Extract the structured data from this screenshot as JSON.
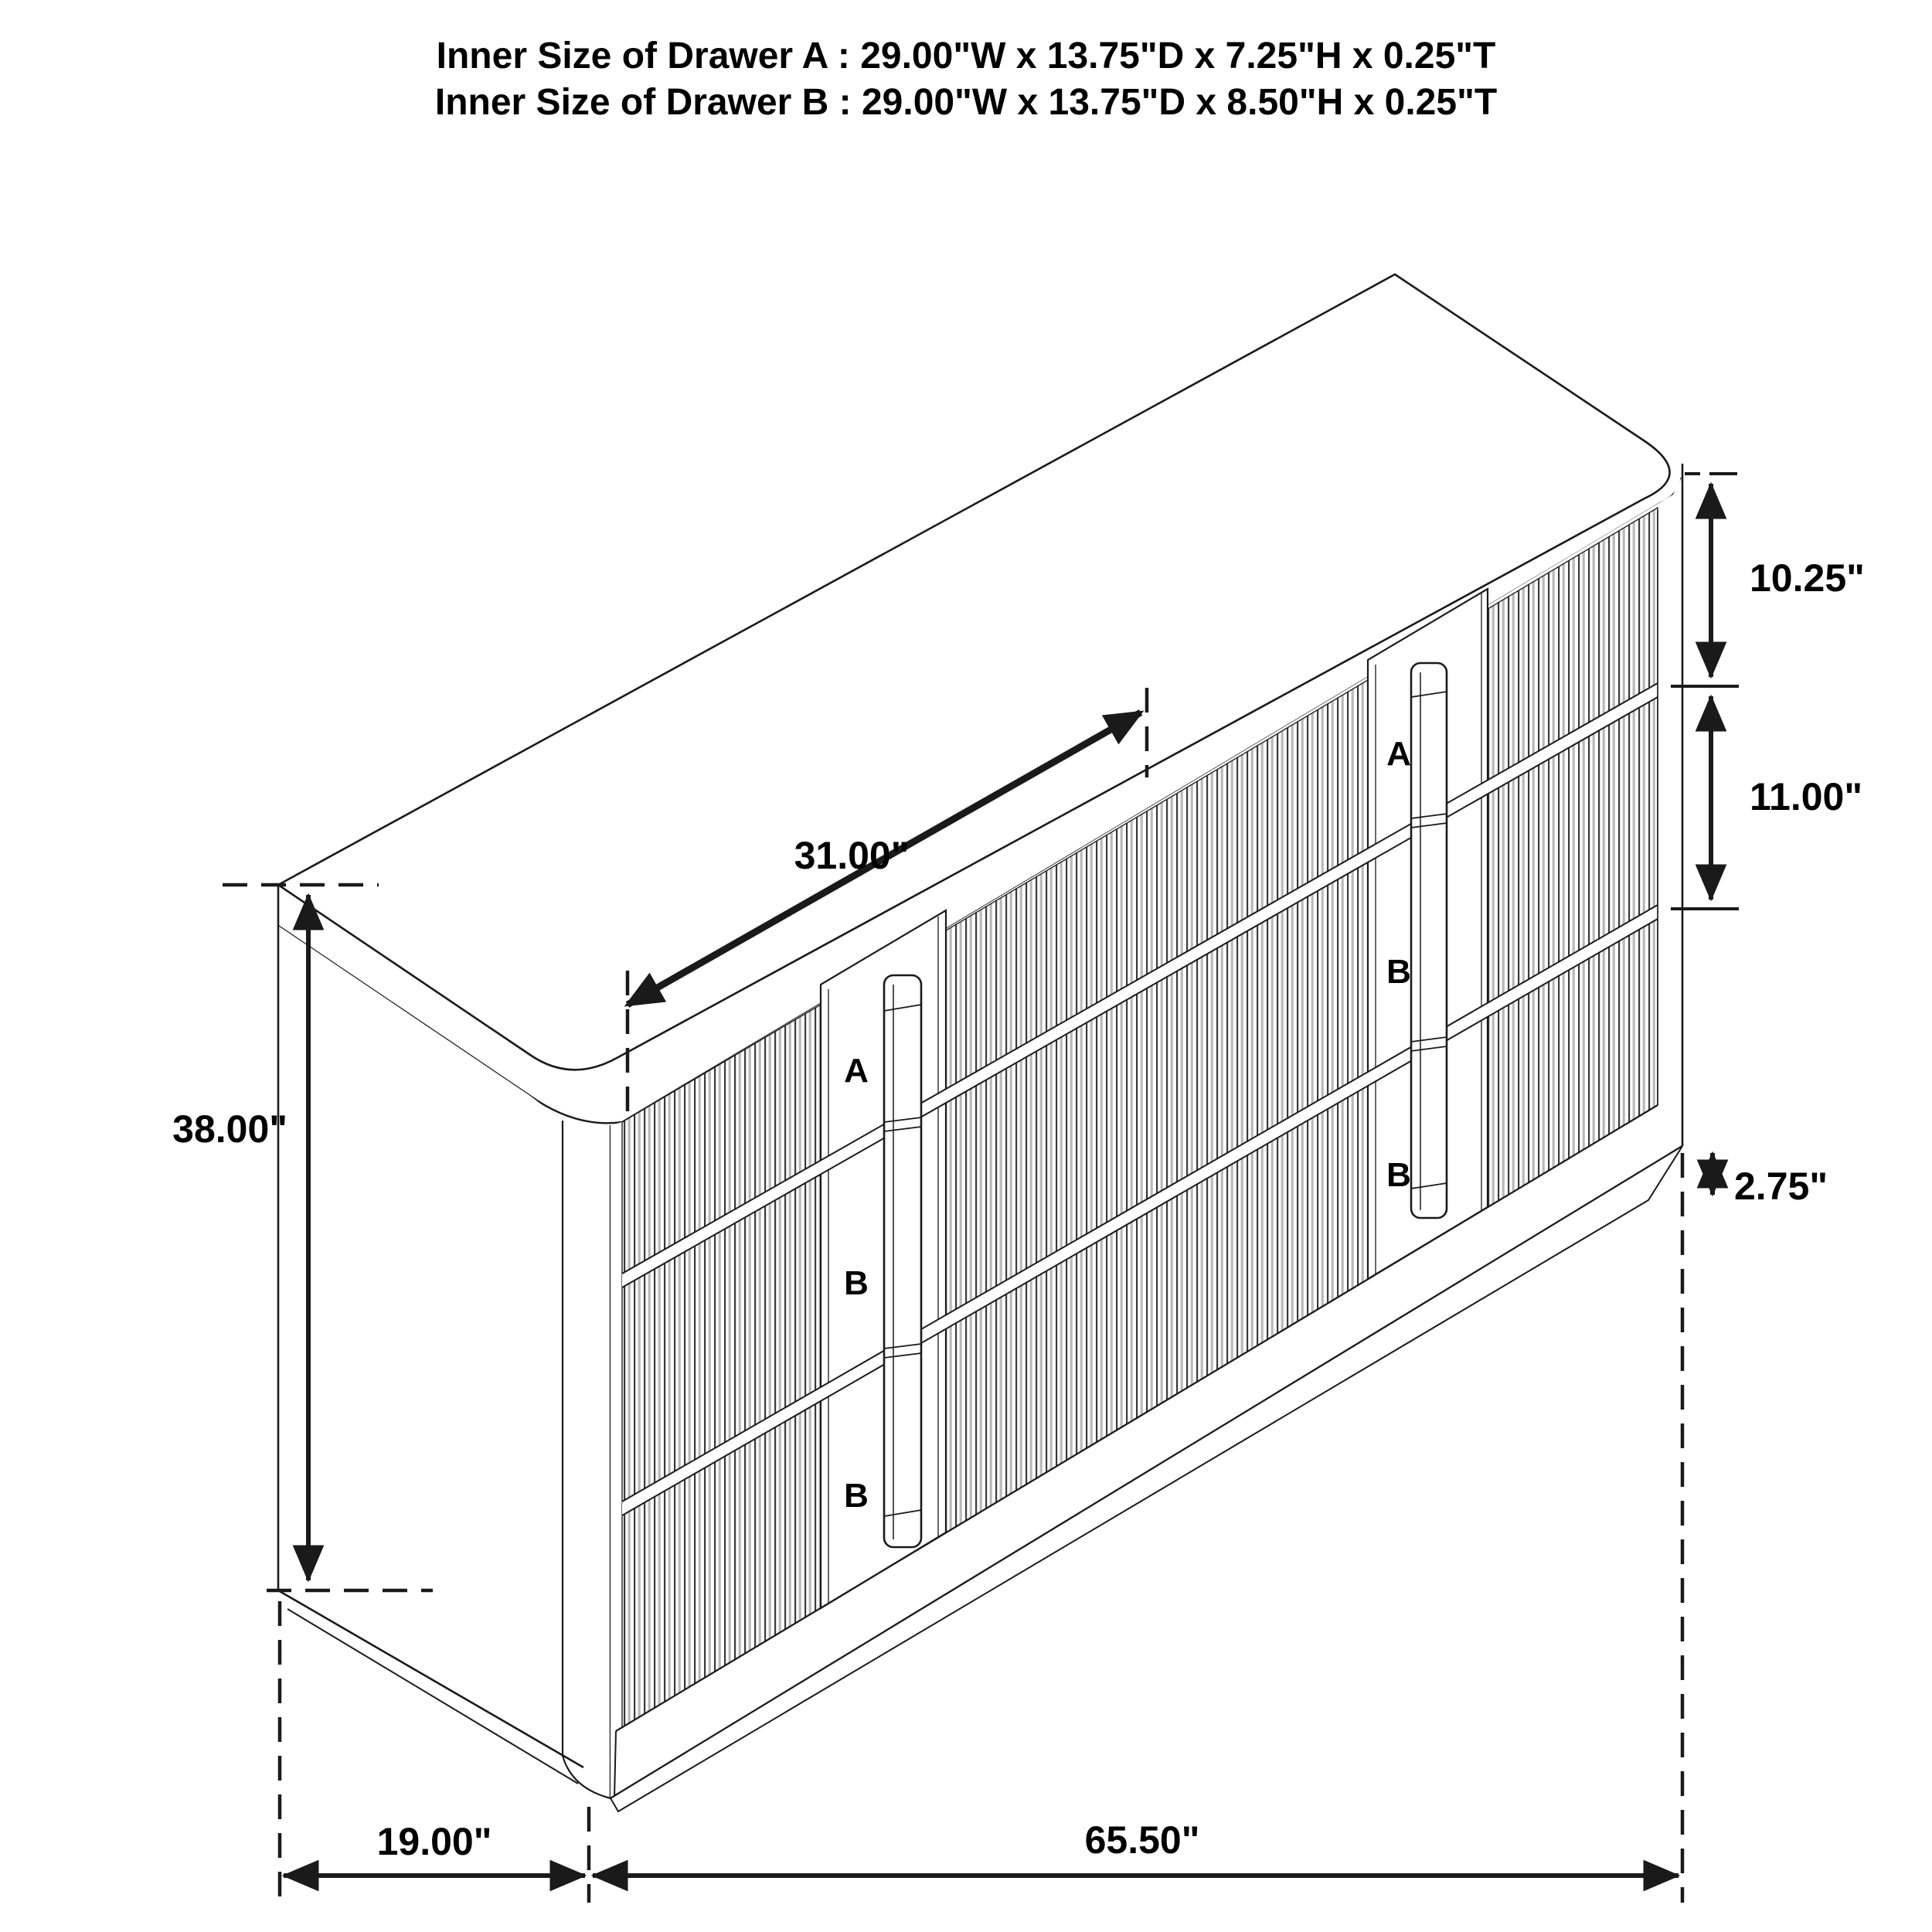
{
  "title": {
    "line1": "Inner Size of Drawer A : 29.00\"W x 13.75\"D x 7.25\"H x 0.25\"T",
    "line2": "Inner Size of Drawer B : 29.00\"W x 13.75\"D x 8.50\"H x 0.25\"T"
  },
  "dimensions": {
    "top_width": "31.00\"",
    "height": "38.00\"",
    "depth": "19.00\"",
    "width": "65.50\"",
    "top_drawer_front": "10.25\"",
    "middle_drawer_front": "11.00\"",
    "base_height": "2.75\""
  },
  "drawer_labels": {
    "left": [
      "A",
      "B",
      "B"
    ],
    "right": [
      "A",
      "B",
      "B"
    ]
  },
  "colors": {
    "line": "#1a1a1a",
    "label_red": "#ec1c24",
    "flute_dark": "#3a3a3a",
    "flute_gray": "#b9b9b9",
    "background": "#ffffff"
  }
}
